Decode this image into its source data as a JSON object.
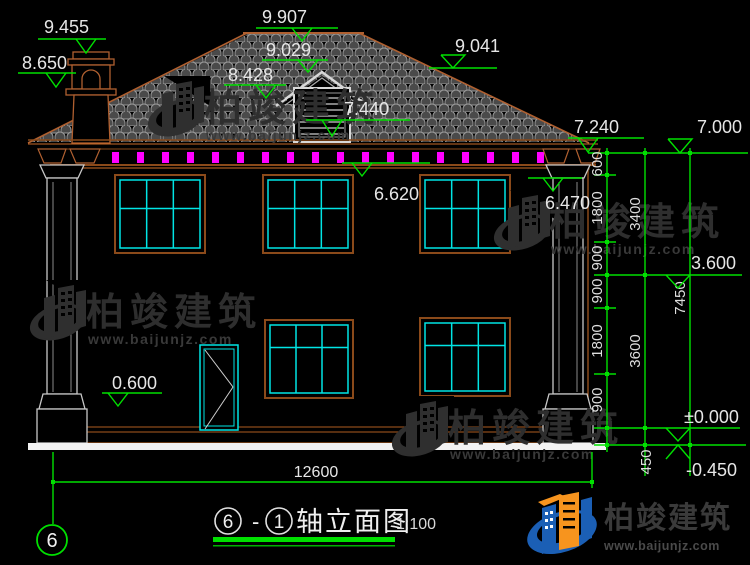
{
  "brand": {
    "name": "柏竣建筑",
    "site": "www.baijunjz.com"
  },
  "title_block": {
    "axis_start": "6",
    "separator": "-",
    "axis_end": "1",
    "name": "轴立面图",
    "scale": "1:100"
  },
  "axis_bubble": {
    "label": "6"
  },
  "elevations": {
    "chimney_top": "9.455",
    "chimney_cap": "8.650",
    "ridge": "9.907",
    "dormer_ridge": "9.029",
    "dormer_eave": "8.428",
    "dormer_vent_sill": "7.440",
    "roof_right": "9.041",
    "eave_right": "7.240",
    "level_top_right": "7.000",
    "soffit_mid": "6.620",
    "capital_right": "6.470",
    "floor_two": "3.600",
    "plinth_left": "0.600",
    "zero_level": "±0.000",
    "ground": "-0.450"
  },
  "dimensions": {
    "total_width": "12600",
    "right_outer_total": "7450",
    "right_middle": [
      "3400",
      "3600"
    ],
    "right_offset": "450",
    "right_inner": [
      "600",
      "1800",
      "900",
      "900",
      "1800",
      "900"
    ]
  }
}
